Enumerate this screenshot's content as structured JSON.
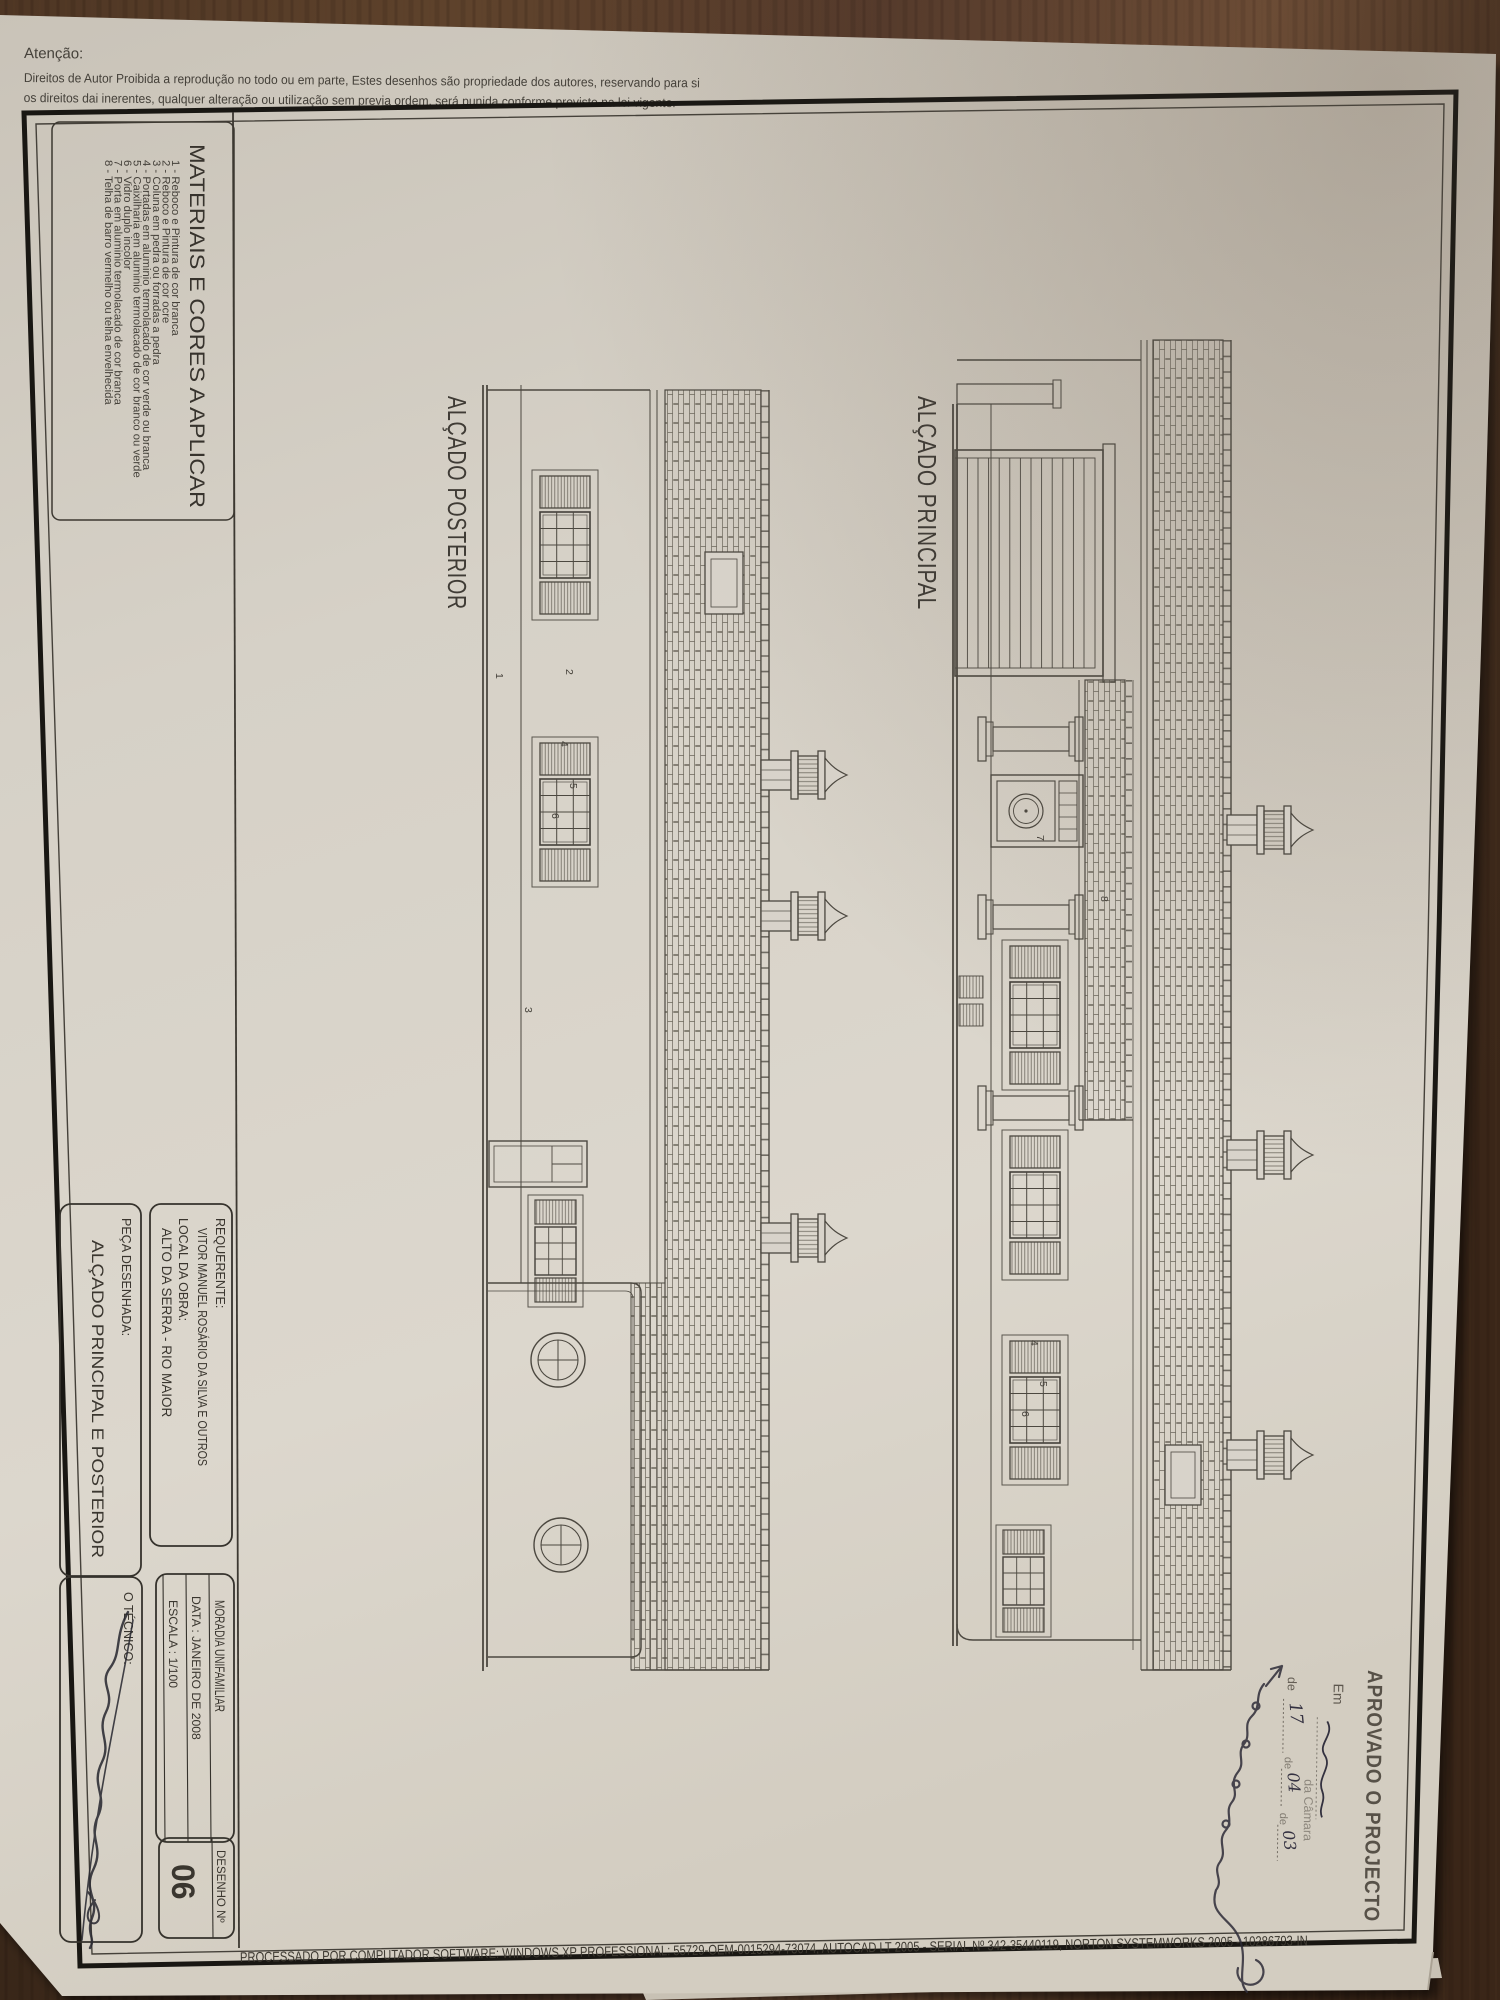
{
  "sheet": {
    "notice": {
      "title": "Atenção:",
      "line1": "Direitos de Autor Proibida a reprodução no todo ou em parte, Estes desenhos são propriedade dos autores, reservando para si",
      "line2": "os direitos dai inerentes, qualquer alteração ou utilização sem previa ordem, será punida conforme previsto na lei vigente."
    },
    "materials": {
      "title": "MATERIAIS E CORES A APLICAR",
      "items": [
        "1 - Reboco e Pintura de cor branca",
        "2 - Reboco e Pintura de cor ocre",
        "3 - Coluna em pedra ou forradas a pedra",
        "4 - Portadas em aluminio termolacado de cor verde ou branca",
        "5 - Caixilharia em aluminio termolacado de cor branco ou verde",
        "6 - Vidro duplo incolor",
        "7 - Porta em aluminio termolacado de cor branca",
        "8 - Telha de barro vermelho ou telha envelhecida"
      ]
    },
    "elevations": {
      "posterior": "ALÇADO POSTERIOR",
      "principal": "ALÇADO PRINCIPAL"
    },
    "title_block": {
      "requerente_label": "REQUERENTE:",
      "requerente_value": "VITOR MANUEL ROSÁRIO DA SILVA E OUTROS",
      "local_label": "LOCAL DA OBRA:",
      "local_value": "ALTO DA SERRA - RIO MAIOR",
      "peca_label": "PEÇA DESENHADA:",
      "peca_value": "ALÇADO PRINCIPAL E POSTERIOR",
      "tipo": "MORADIA UNIFAMILIAR",
      "data": "DATA : JANEIRO DE 2008",
      "escala": "ESCALA : 1/100",
      "tecnico_label": "O TÉCNICO:",
      "desenho_label": "DESENHO  Nº",
      "desenho_value": "06"
    },
    "stamp": {
      "title": "APROVADO O PROJECTO",
      "line_em": "Em",
      "line_camara": "da Câmara",
      "line_de": "de",
      "hand_day": "17",
      "hand_de2": "de",
      "hand_month": "04",
      "hand_de3": "de",
      "hand_year": "03"
    },
    "footer": "PROCESSADO POR COMPUTADOR SOFTWARE: WINDOWS XP PROFESSIONAL:  55729-OEM-0015294-73074, AUTOCAD LT 2005 - SERIAL Nº  342-35440119, NORTON SYSTEMWORKS 2005 - 10286793-IN",
    "callouts": [
      "1",
      "2",
      "3",
      "4",
      "5",
      "6",
      "7",
      "8"
    ],
    "ink": "#4c4840",
    "paper_color": "#d8d3ca",
    "wood_color": "#57402b"
  }
}
